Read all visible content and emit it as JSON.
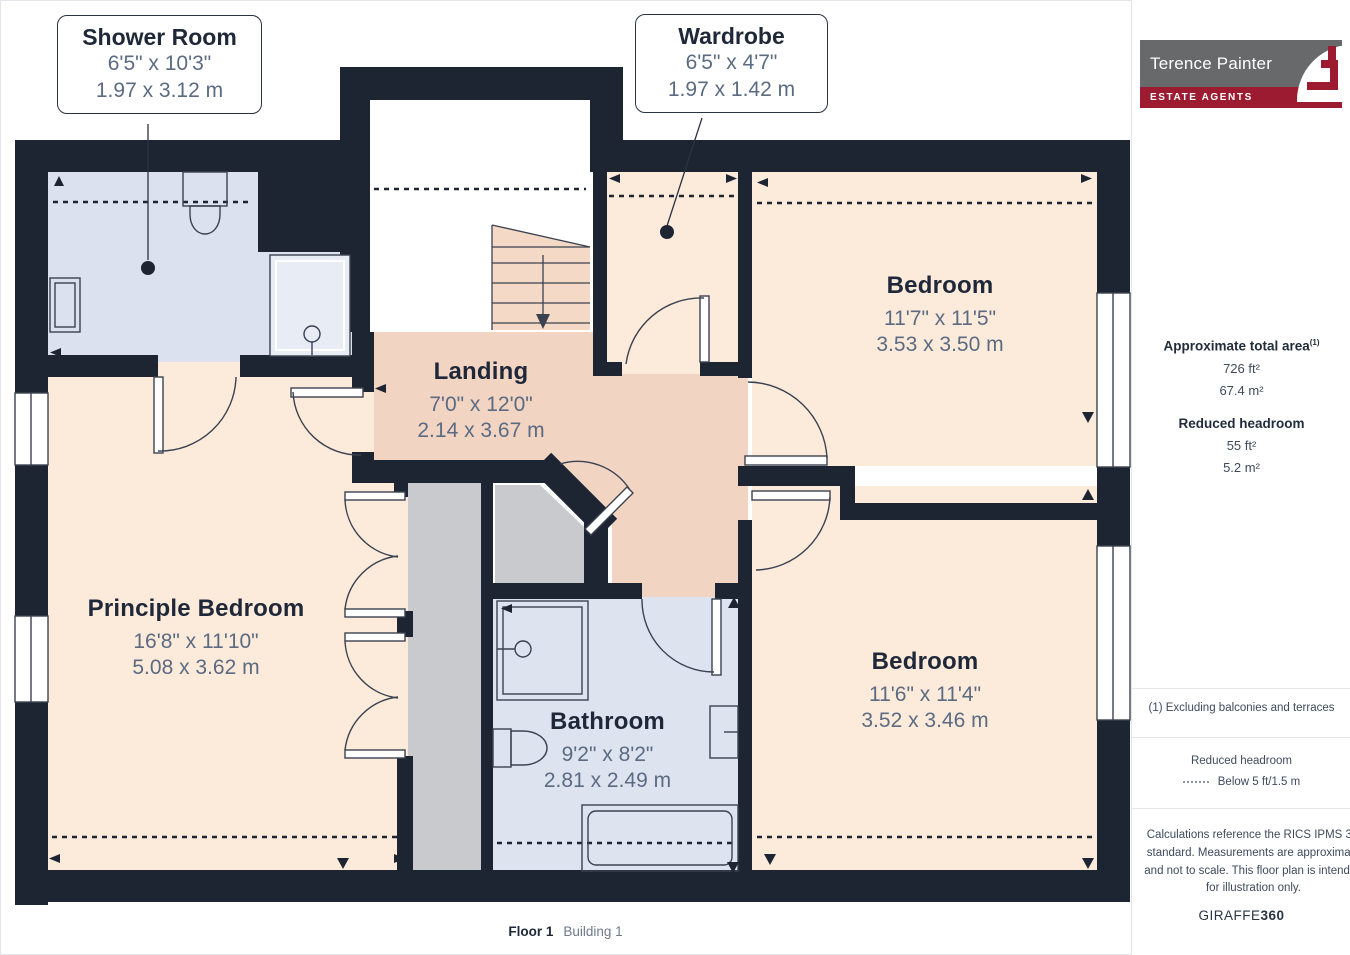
{
  "plan": {
    "floor_label": "Floor 1",
    "building_label": "Building 1",
    "rooms": {
      "shower_room": {
        "name": "Shower Room",
        "imperial": "6'5\" x 10'3\"",
        "metric": "1.97 x 3.12 m"
      },
      "wardrobe": {
        "name": "Wardrobe",
        "imperial": "6'5\" x 4'7\"",
        "metric": "1.97 x 1.42 m"
      },
      "landing": {
        "name": "Landing",
        "imperial": "7'0\" x 12'0\"",
        "metric": "2.14 x 3.67 m"
      },
      "bedroom_top": {
        "name": "Bedroom",
        "imperial": "11'7\" x 11'5\"",
        "metric": "3.53 x 3.50 m"
      },
      "bedroom_bottom": {
        "name": "Bedroom",
        "imperial": "11'6\" x 11'4\"",
        "metric": "3.52 x 3.46 m"
      },
      "principle_bedroom": {
        "name": "Principle Bedroom",
        "imperial": "16'8\" x 11'10\"",
        "metric": "5.08 x 3.62 m"
      },
      "bathroom": {
        "name": "Bathroom",
        "imperial": "9'2\" x 8'2\"",
        "metric": "2.81 x 2.49 m"
      }
    }
  },
  "sidebar": {
    "logo": {
      "brand": "Terence Painter",
      "tagline": "ESTATE AGENTS"
    },
    "area": {
      "title": "Approximate total area",
      "footnote_marker": "(1)",
      "imperial": "726 ft²",
      "metric": "67.4 m²"
    },
    "reduced_headroom": {
      "title": "Reduced headroom",
      "imperial": "55 ft²",
      "metric": "5.2 m²"
    },
    "footnote": "(1) Excluding balconies and terraces",
    "legend": {
      "title": "Reduced headroom",
      "label": "Below 5 ft/1.5 m"
    },
    "disclaimer": "Calculations reference the RICS IPMS 3C standard. Measurements are approximate and not to scale. This floor plan is intended for illustration only.",
    "credit": {
      "brand": "GIRAFFE",
      "suffix": "360"
    }
  },
  "colors": {
    "wall": "#1d2532",
    "room_peach": "#fceadb",
    "room_pink": "#f2d4c3",
    "room_blue": "#dee3f0",
    "closet_gray": "#c9cacd",
    "brand_maroon": "#9c1b31",
    "brand_gray": "#68696b",
    "dim_text": "#5b6b82",
    "title_text": "#1f2839"
  }
}
